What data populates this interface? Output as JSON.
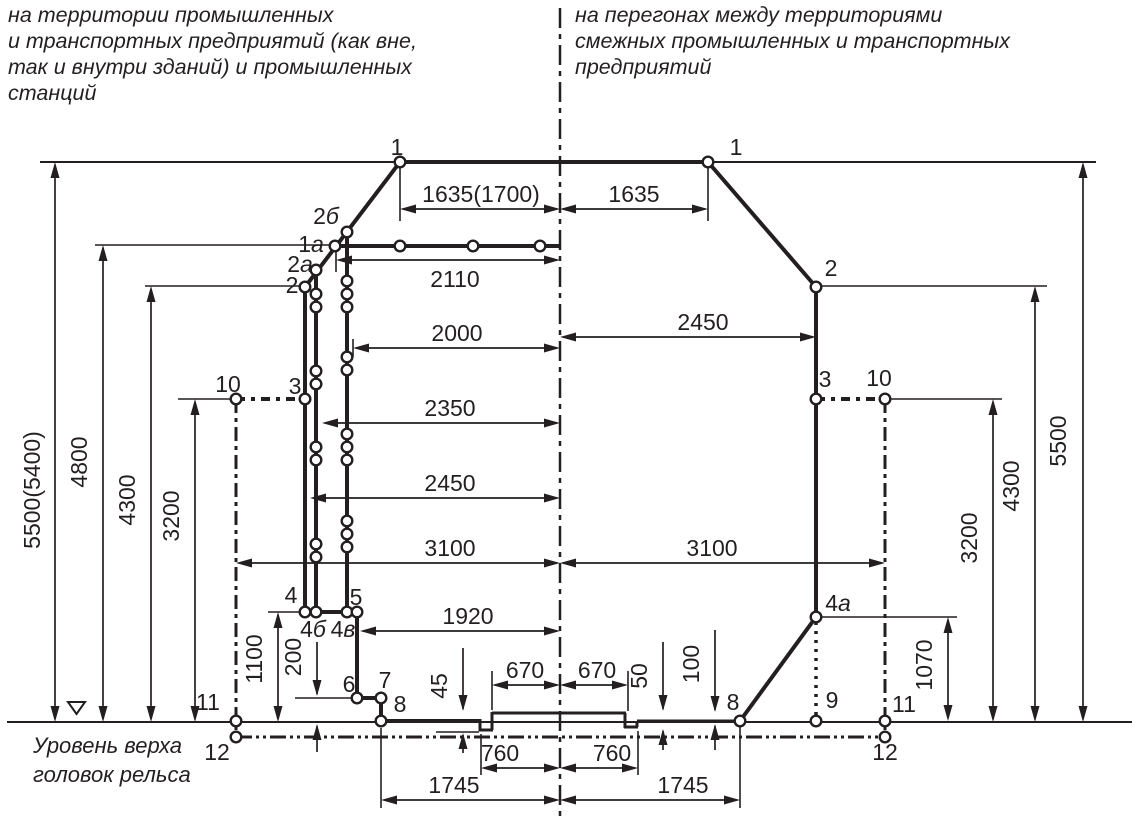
{
  "header_left": {
    "text": "на территории промышленных\nи транспортных предприятий (как вне,\nтак и внутри зданий) и промышленных\nстанций"
  },
  "header_right": {
    "text": "на перегонах между территориями\nсмежных промышленных и транспортных\nпредприятий"
  },
  "rail_level_label": {
    "text": "Уровень верха\nголовок рельса"
  },
  "colors": {
    "ink": "#231f20",
    "bg": "#ffffff"
  },
  "diagram": {
    "width": 1139,
    "height": 827,
    "thick": [
      [
        400,
        162,
        708,
        162
      ],
      [
        400,
        162,
        305,
        287
      ],
      [
        708,
        162,
        816,
        287
      ],
      [
        305,
        287,
        305,
        612
      ],
      [
        316,
        270,
        316,
        612
      ],
      [
        347,
        232,
        347,
        612
      ],
      [
        335,
        246,
        560,
        246
      ],
      [
        305,
        612,
        357,
        612
      ],
      [
        357,
        612,
        357,
        698
      ],
      [
        357,
        698,
        381,
        698
      ],
      [
        381,
        698,
        381,
        721
      ],
      [
        381,
        721,
        481,
        721
      ],
      [
        816,
        287,
        816,
        617
      ],
      [
        816,
        617,
        740,
        721
      ]
    ],
    "profile3": [
      [
        480,
        719,
        480,
        731
      ],
      [
        479,
        730,
        493,
        730
      ],
      [
        492,
        730,
        492,
        712
      ],
      [
        492,
        713,
        560,
        713
      ],
      [
        560,
        713,
        626,
        713
      ],
      [
        625,
        713,
        625,
        728
      ],
      [
        624,
        727,
        638,
        727
      ],
      [
        637,
        727,
        637,
        721
      ],
      [
        637,
        721,
        740,
        721
      ]
    ],
    "medium": [
      [
        40,
        162,
        1096,
        162
      ],
      [
        7,
        722,
        1132,
        722
      ]
    ],
    "thin": [
      [
        95,
        245,
        336,
        245
      ],
      [
        145,
        286,
        305,
        286
      ],
      [
        178,
        399,
        236,
        399
      ],
      [
        268,
        612,
        305,
        612
      ],
      [
        295,
        698,
        357,
        698
      ],
      [
        816,
        286,
        1047,
        286
      ],
      [
        885,
        399,
        1002,
        399
      ],
      [
        816,
        617,
        957,
        617
      ],
      [
        400,
        168,
        400,
        221
      ],
      [
        708,
        168,
        708,
        221
      ],
      [
        336,
        252,
        336,
        272
      ],
      [
        353,
        339,
        353,
        357
      ],
      [
        492,
        671,
        492,
        710
      ],
      [
        628,
        671,
        628,
        711
      ],
      [
        481,
        734,
        481,
        775
      ],
      [
        638,
        731,
        638,
        775
      ],
      [
        381,
        728,
        381,
        808
      ],
      [
        740,
        727,
        740,
        808
      ],
      [
        436,
        732,
        479,
        732
      ]
    ],
    "dash_dot": [
      {
        "seg": [
          560,
          8,
          560,
          822
        ],
        "w": 2.5,
        "p": "20 6 5 6"
      },
      {
        "seg": [
          236,
          399,
          236,
          737
        ],
        "w": 3,
        "p": "14 5 4 5"
      },
      {
        "seg": [
          885,
          399,
          885,
          737
        ],
        "w": 3,
        "p": "14 5 4 5"
      },
      {
        "seg": [
          236,
          399,
          305,
          399
        ],
        "w": 4,
        "p": "9 6 4 6"
      },
      {
        "seg": [
          816,
          399,
          885,
          399
        ],
        "w": 4,
        "p": "9 6 4 6"
      }
    ],
    "dash_dot_dot": [
      {
        "seg": [
          236,
          737,
          885,
          737
        ],
        "w": 3,
        "p": "16 4 3 4 3 4"
      }
    ],
    "dotted": [
      {
        "seg": [
          816,
          622,
          816,
          717
        ],
        "w": 3.5,
        "p": "3 6"
      }
    ],
    "circles": [
      [
        400,
        162
      ],
      [
        708,
        162
      ],
      [
        347,
        232
      ],
      [
        335,
        246
      ],
      [
        400,
        246
      ],
      [
        473,
        246
      ],
      [
        540,
        246
      ],
      [
        316,
        270
      ],
      [
        305,
        287
      ],
      [
        816,
        287
      ],
      [
        305,
        399
      ],
      [
        816,
        399
      ],
      [
        236,
        399
      ],
      [
        885,
        399
      ],
      [
        347,
        281
      ],
      [
        347,
        294
      ],
      [
        347,
        307
      ],
      [
        347,
        357
      ],
      [
        347,
        370
      ],
      [
        347,
        434
      ],
      [
        347,
        447
      ],
      [
        347,
        460
      ],
      [
        347,
        521
      ],
      [
        347,
        534
      ],
      [
        347,
        547
      ],
      [
        316,
        294
      ],
      [
        316,
        307
      ],
      [
        316,
        371
      ],
      [
        316,
        384
      ],
      [
        316,
        447
      ],
      [
        316,
        460
      ],
      [
        316,
        544
      ],
      [
        316,
        557
      ],
      [
        305,
        612
      ],
      [
        316,
        612
      ],
      [
        347,
        612
      ],
      [
        357,
        612
      ],
      [
        357,
        698
      ],
      [
        381,
        698
      ],
      [
        381,
        721
      ],
      [
        740,
        721
      ],
      [
        816,
        721
      ],
      [
        816,
        617
      ],
      [
        236,
        721
      ],
      [
        236,
        737
      ],
      [
        885,
        721
      ],
      [
        885,
        737
      ]
    ],
    "point_labels": [
      {
        "t": "1",
        "i": "",
        "x": 397,
        "y": 155
      },
      {
        "t": "1",
        "i": "",
        "x": 736,
        "y": 155
      },
      {
        "t": "2",
        "i": "б",
        "x": 326,
        "y": 224
      },
      {
        "t": "1",
        "i": "а",
        "x": 311,
        "y": 252
      },
      {
        "t": "2",
        "i": "а",
        "x": 300,
        "y": 272
      },
      {
        "t": "2",
        "i": "",
        "x": 292,
        "y": 293
      },
      {
        "t": "3",
        "i": "",
        "x": 295,
        "y": 394
      },
      {
        "t": "10",
        "i": "",
        "x": 228,
        "y": 392
      },
      {
        "t": "4",
        "i": "",
        "x": 291,
        "y": 603
      },
      {
        "t": "4",
        "i": "б",
        "x": 313,
        "y": 637
      },
      {
        "t": "4",
        "i": "в",
        "x": 343,
        "y": 637
      },
      {
        "t": "5",
        "i": "",
        "x": 356,
        "y": 605
      },
      {
        "t": "6",
        "i": "",
        "x": 349,
        "y": 692
      },
      {
        "t": "7",
        "i": "",
        "x": 385,
        "y": 688
      },
      {
        "t": "8",
        "i": "",
        "x": 400,
        "y": 712
      },
      {
        "t": "11",
        "i": "",
        "x": 208,
        "y": 710
      },
      {
        "t": "12",
        "i": "",
        "x": 217,
        "y": 760
      },
      {
        "t": "2",
        "i": "",
        "x": 831,
        "y": 276
      },
      {
        "t": "3",
        "i": "",
        "x": 825,
        "y": 387
      },
      {
        "t": "10",
        "i": "",
        "x": 879,
        "y": 386
      },
      {
        "t": "4",
        "i": "а",
        "x": 838,
        "y": 611
      },
      {
        "t": "9",
        "i": "",
        "x": 832,
        "y": 708
      },
      {
        "t": "8",
        "i": "",
        "x": 733,
        "y": 710
      },
      {
        "t": "11",
        "i": "",
        "x": 904,
        "y": 712
      },
      {
        "t": "12",
        "i": "",
        "x": 885,
        "y": 760
      }
    ],
    "h_dims": [
      {
        "v": "1635(1700)",
        "x1": 400,
        "x2": 560,
        "y": 209,
        "tx": 481,
        "ty": 202
      },
      {
        "v": "1635",
        "x1": 560,
        "x2": 708,
        "y": 209,
        "tx": 634,
        "ty": 202
      },
      {
        "v": "2110",
        "x1": 336,
        "x2": 560,
        "y": 260,
        "tx": 455,
        "ty": 287
      },
      {
        "v": "2000",
        "x1": 353,
        "x2": 560,
        "y": 348,
        "tx": 457,
        "ty": 341
      },
      {
        "v": "2350",
        "x1": 322,
        "x2": 560,
        "y": 423,
        "tx": 450,
        "ty": 416
      },
      {
        "v": "2450",
        "x1": 310,
        "x2": 560,
        "y": 498,
        "tx": 450,
        "ty": 491
      },
      {
        "v": "3100",
        "x1": 236,
        "x2": 560,
        "y": 563,
        "tx": 450,
        "ty": 556
      },
      {
        "v": "2450",
        "x1": 560,
        "x2": 816,
        "y": 337,
        "tx": 703,
        "ty": 330
      },
      {
        "v": "3100",
        "x1": 560,
        "x2": 885,
        "y": 563,
        "tx": 712,
        "ty": 556
      },
      {
        "v": "1920",
        "x1": 360,
        "x2": 560,
        "y": 631,
        "tx": 468,
        "ty": 624
      },
      {
        "v": "670",
        "x1": 492,
        "x2": 560,
        "y": 685,
        "tx": 525,
        "ty": 678
      },
      {
        "v": "670",
        "x1": 560,
        "x2": 628,
        "y": 685,
        "tx": 597,
        "ty": 678
      },
      {
        "v": "760",
        "x1": 481,
        "x2": 560,
        "y": 768,
        "tx": 500,
        "ty": 761
      },
      {
        "v": "760",
        "x1": 560,
        "x2": 638,
        "y": 768,
        "tx": 612,
        "ty": 761
      },
      {
        "v": "1745",
        "x1": 381,
        "x2": 560,
        "y": 800,
        "tx": 454,
        "ty": 793
      },
      {
        "v": "1745",
        "x1": 560,
        "x2": 740,
        "y": 800,
        "tx": 683,
        "ty": 793
      }
    ],
    "v_dims": [
      {
        "v": "5500(5400)",
        "x": 55,
        "y1": 162,
        "y2": 722,
        "tx": 40,
        "ty": 490
      },
      {
        "v": "4800",
        "x": 103,
        "y1": 245,
        "y2": 722,
        "tx": 87,
        "ty": 462
      },
      {
        "v": "4300",
        "x": 151,
        "y1": 286,
        "y2": 722,
        "tx": 135,
        "ty": 500
      },
      {
        "v": "3200",
        "x": 195,
        "y1": 399,
        "y2": 722,
        "tx": 179,
        "ty": 516
      },
      {
        "v": "1100",
        "x": 278,
        "y1": 612,
        "y2": 722,
        "tx": 262,
        "ty": 659
      },
      {
        "v": "1070",
        "x": 948,
        "y1": 617,
        "y2": 721,
        "tx": 932,
        "ty": 665
      },
      {
        "v": "3200",
        "x": 993,
        "y1": 399,
        "y2": 722,
        "tx": 977,
        "ty": 538
      },
      {
        "v": "4300",
        "x": 1035,
        "y1": 286,
        "y2": 722,
        "tx": 1019,
        "ty": 486
      },
      {
        "v": "5500",
        "x": 1083,
        "y1": 162,
        "y2": 722,
        "tx": 1066,
        "ty": 441
      }
    ],
    "split_dims": [
      {
        "v": "45",
        "x": 463,
        "a1": 648,
        "a2": 711,
        "b1": 733,
        "b2": 753,
        "tx": 447,
        "ty": 686
      },
      {
        "v": "50",
        "x": 663,
        "a1": 642,
        "a2": 711,
        "b1": 729,
        "b2": 750,
        "tx": 647,
        "ty": 676
      },
      {
        "v": "100",
        "x": 715,
        "a1": 630,
        "a2": 712,
        "b1": 724,
        "b2": 750,
        "tx": 699,
        "ty": 664
      },
      {
        "v": "200",
        "x": 317,
        "a1": 642,
        "a2": 696,
        "b1": 724,
        "b2": 752,
        "tx": 301,
        "ty": 657
      }
    ],
    "ground_marker": {
      "points": "68,702 85,702 76.5,714"
    }
  }
}
